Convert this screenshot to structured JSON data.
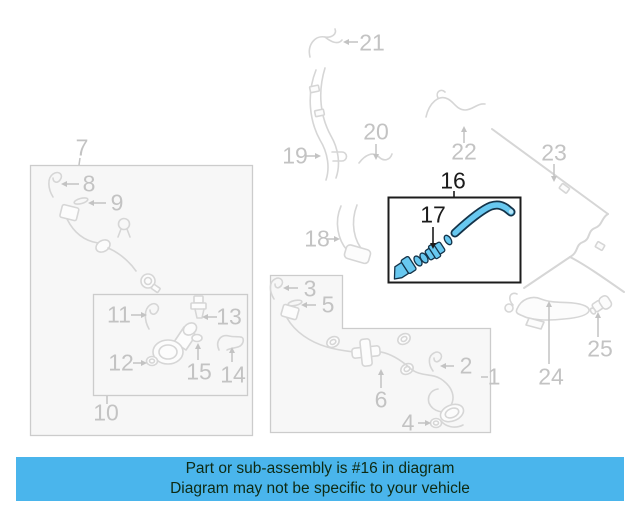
{
  "banner": {
    "line1": "Part or sub-assembly is #16 in diagram",
    "line2": "Diagram may not be specific to your vehicle"
  },
  "highlighted_part_number": "16",
  "highlighted_sub_part_number": "17",
  "labels": {
    "1": "1",
    "2": "2",
    "3": "3",
    "4": "4",
    "5": "5",
    "6": "6",
    "7": "7",
    "8": "8",
    "9": "9",
    "10": "10",
    "11": "11",
    "12": "12",
    "13": "13",
    "14": "14",
    "15": "15",
    "16": "16",
    "17": "17",
    "18": "18",
    "19": "19",
    "20": "20",
    "21": "21",
    "22": "22",
    "23": "23",
    "24": "24",
    "25": "25"
  },
  "colors": {
    "banner_bg": "#4ab5ec",
    "banner_text": "#0e2a12",
    "highlight_fill": "#68c8f0",
    "highlight_outline": "#143349",
    "highlight_box_border": "#1c1c1c",
    "diagram_line": "#d6d6d6",
    "diagram_label": "#c3c3c3",
    "box_fill": "#f7f7f7",
    "box_border": "#cccccc"
  }
}
